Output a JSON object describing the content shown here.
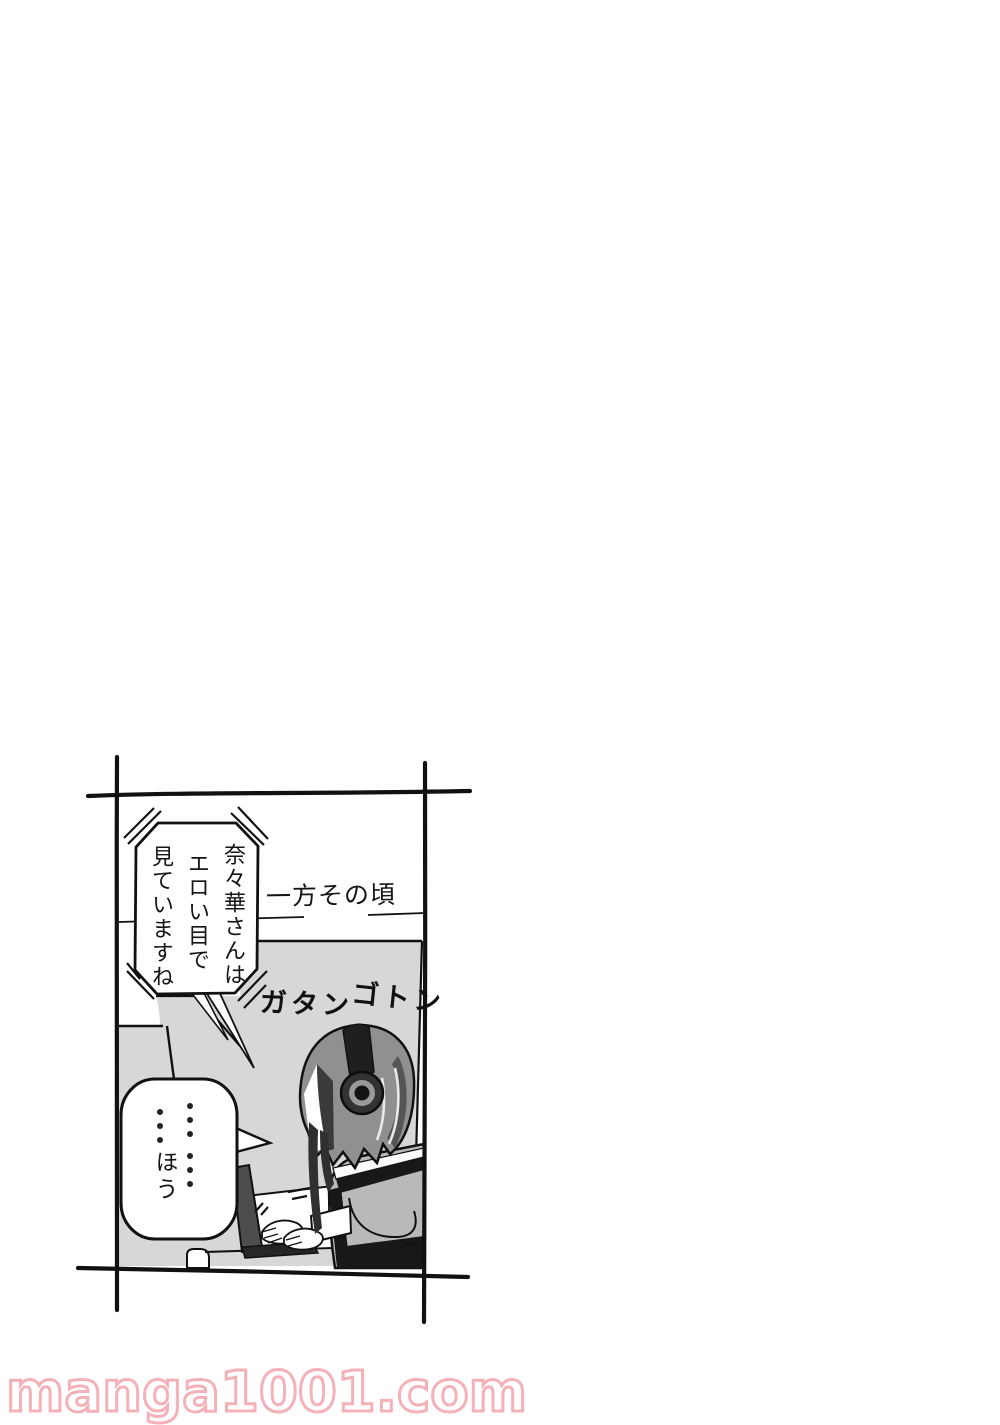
{
  "page": {
    "background_color": "#ffffff",
    "watermark": {
      "text": "manga1001.com",
      "fill_color": "#ffffff",
      "outline_color": "#f4b2b8"
    }
  },
  "panel": {
    "border_color": "#111111",
    "caption": {
      "text": "一方その頃"
    },
    "sfx": {
      "full": "ガタン ゴトン",
      "part1": "ガタン",
      "part2": "ゴトン"
    },
    "bubble1": {
      "style": "octagonal burst balloon (off-panel voice)",
      "col1": "奈々華さんは",
      "col2": "エロい目で",
      "col3": "見ていますね"
    },
    "bubble2": {
      "style": "rounded balloon",
      "dots_col1": "……",
      "dots_col2": "…",
      "word": "ほう"
    },
    "scene": {
      "subject": "girl wearing headphones typing on a laptop in a train seat",
      "colors": {
        "wall_gray": "#d7d7d7",
        "hair_gray": "#909090",
        "clothes_gray": "#b9b9b9",
        "laptop_gray": "#4d4d4d",
        "outline": "#111111"
      }
    }
  }
}
